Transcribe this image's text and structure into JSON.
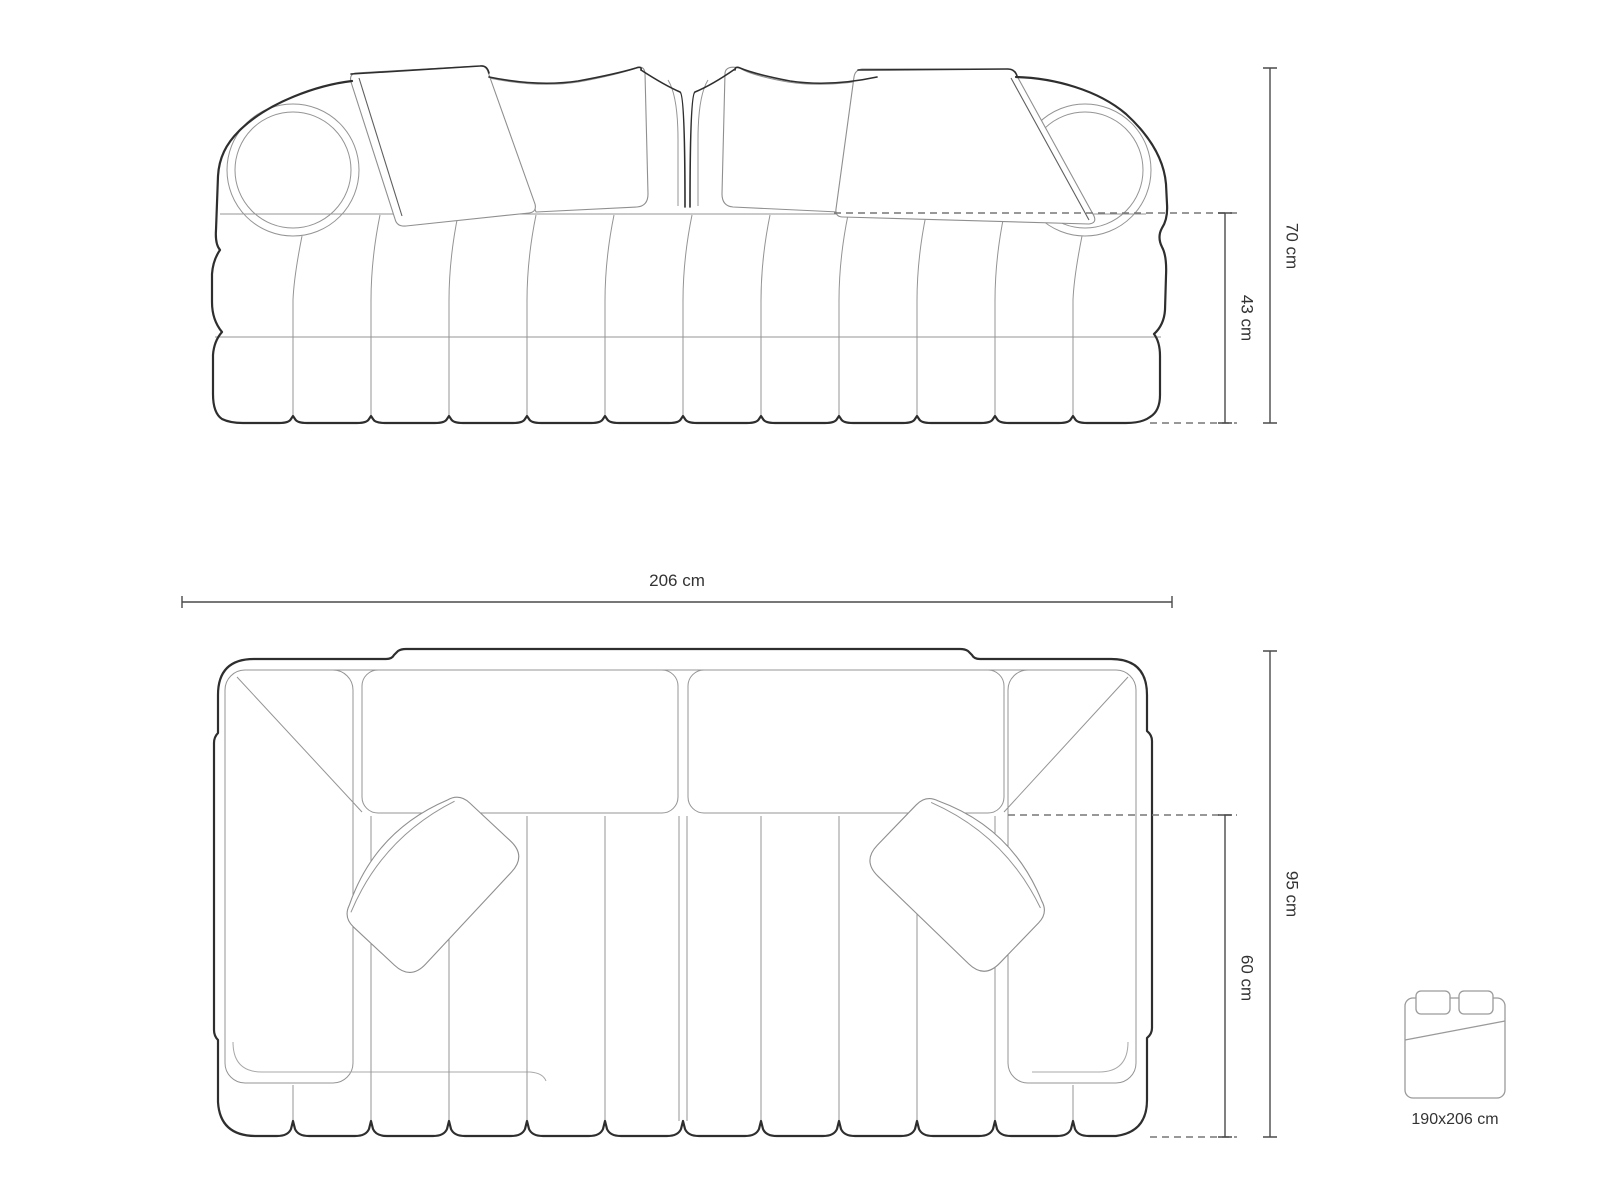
{
  "diagram_title": "sofa-technical-drawing",
  "front_view": {
    "name": "front elevation",
    "height_label": "70 cm",
    "seat_height_label": "43 cm"
  },
  "top_view": {
    "name": "plan view",
    "width_label": "206 cm",
    "depth_label": "95 cm",
    "seat_depth_label": "60 cm"
  },
  "bed_icon": {
    "icon": "bed-sleeping-area-icon",
    "size_label": "190x206 cm"
  },
  "dimensions": {
    "overall_width_cm": 206,
    "overall_height_cm": 70,
    "seat_height_cm": 43,
    "overall_depth_cm": 95,
    "seat_depth_cm": 60,
    "sleeping_area_cm": "190x206"
  },
  "colors": {
    "background": "#ffffff",
    "outline_dark": "#2e2e2e",
    "line_light": "#949494",
    "dimension_line": "#4a4a4a",
    "dashed_line": "#767676",
    "label_text": "#333333"
  }
}
